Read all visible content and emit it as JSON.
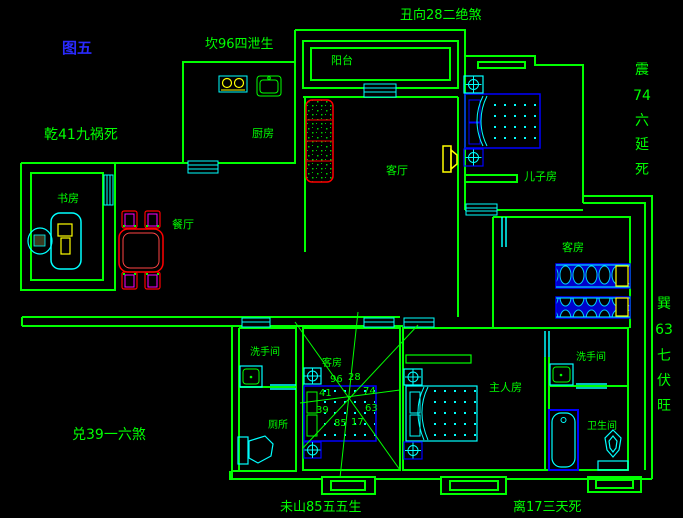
{
  "title": {
    "figure_label": "图五"
  },
  "annotations": {
    "top": "丑向28二绝煞",
    "upper_left": "坎96四泄生",
    "left": "乾41九祸死",
    "lower_left": "兑39一六煞",
    "bottom_left": "未山85五五生",
    "bottom_right": "离17三天死",
    "right_upper": {
      "chars": [
        "震",
        "74",
        "六",
        "延",
        "死"
      ]
    },
    "right_lower": {
      "chars": [
        "巽",
        "63",
        "七",
        "伏",
        "旺"
      ]
    }
  },
  "rooms": {
    "balcony": "阳台",
    "kitchen": "厨房",
    "study": "书房",
    "dining": "餐厅",
    "living": "客厅",
    "sons_room": "儿子房",
    "guest_room_right": "客房",
    "guest_room_middle": "客房",
    "washroom_left": "洗手间",
    "toilet": "厕所",
    "master_room": "主人房",
    "washroom_right": "洗手间",
    "bathroom": "卫生间"
  },
  "compass": {
    "numbers": [
      "96",
      "28",
      "41",
      "74",
      "39",
      "63",
      "85",
      "17"
    ]
  },
  "colors": {
    "background": "#000000",
    "wall_green": "#00ff00",
    "fixture_cyan": "#00ffff",
    "bed_blue": "#0000ff",
    "accent_red": "#ff0000",
    "accent_magenta": "#ff00ff",
    "accent_yellow": "#ffff00",
    "figure_label_blue": "#2a2aff"
  }
}
